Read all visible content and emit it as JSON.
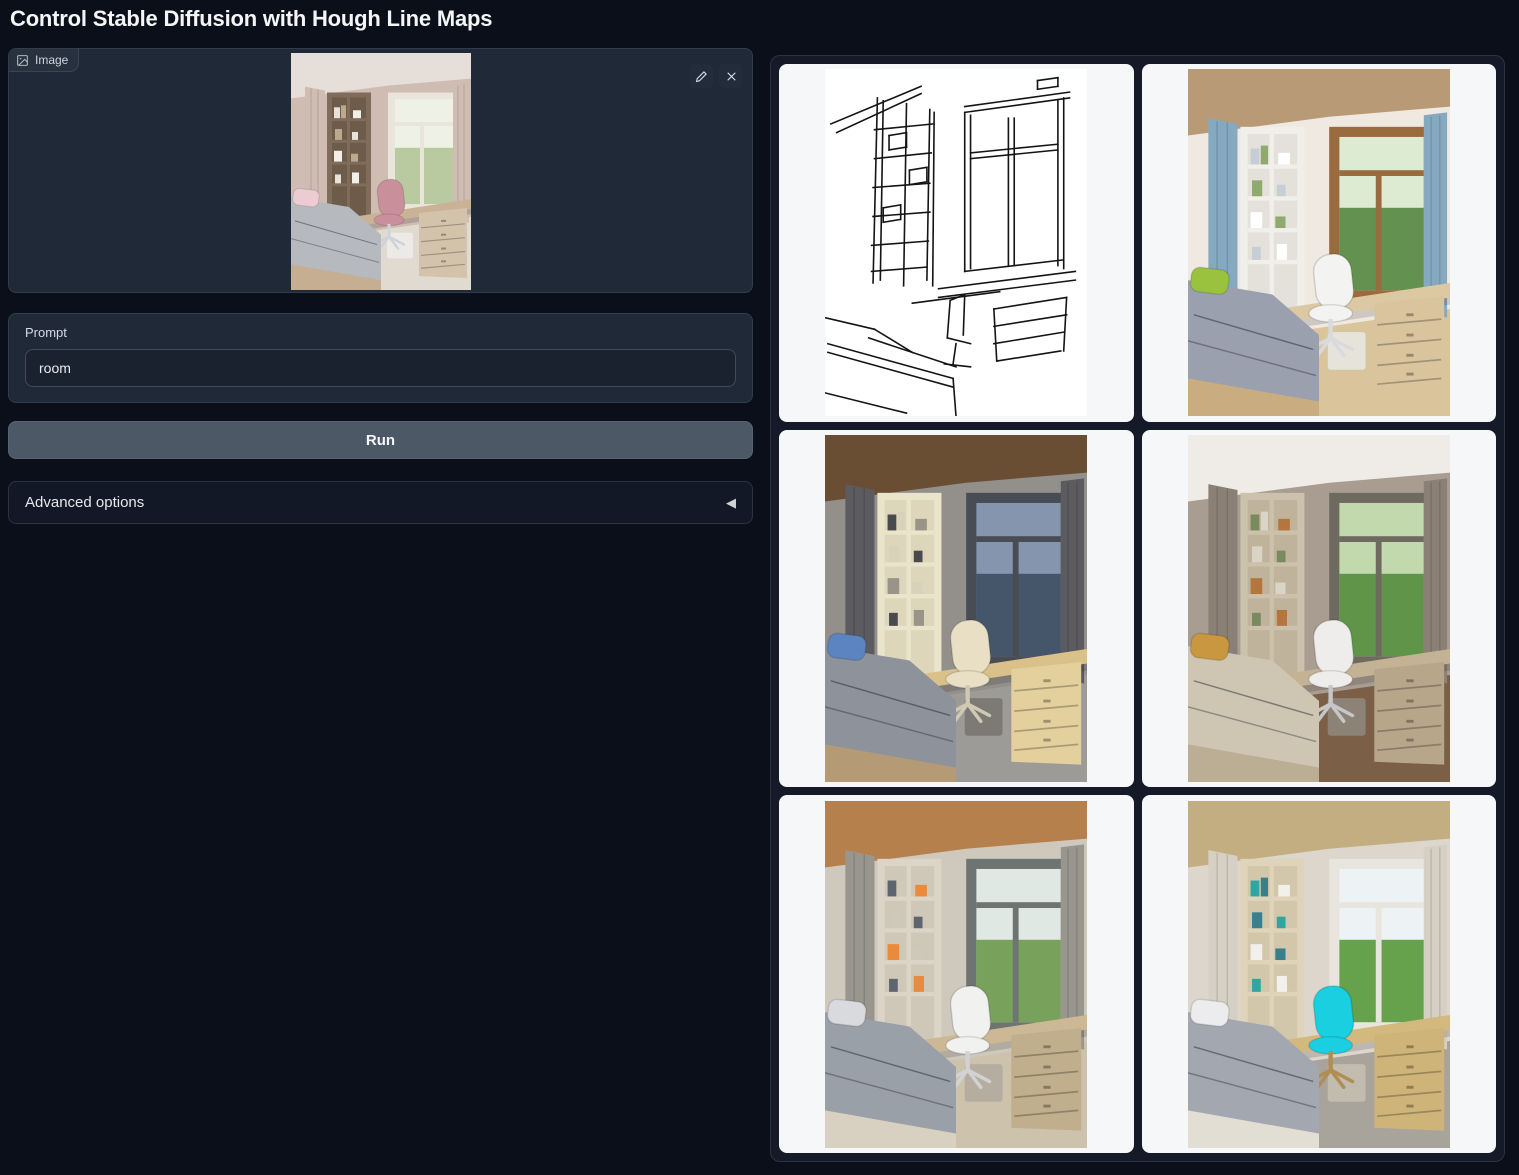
{
  "header": {
    "title": "Control Stable Diffusion with Hough Line Maps"
  },
  "input_panel": {
    "image_component": {
      "label": "Image",
      "edit_tooltip": "Edit",
      "clear_tooltip": "Clear",
      "image_description": "Uploaded photo of a child's bedroom with grey bed, pink desk chair, tall wooden bookshelf and bright window",
      "palette": {
        "wall": "#cfbcb2",
        "ceiling": "#e6ded8",
        "floor": "#e0dad0",
        "sky": "#eef2e6",
        "green": "#b9c9a0",
        "frame": "#e9e5db",
        "curtain": "#cfbcb2",
        "shelf": "#7f6c5a",
        "shelfin": "#6e5c4b",
        "desk": "#c9b296",
        "drawer": "#d3c3ab",
        "chair": "#c98f9b",
        "chairleg": "#cfd2d6",
        "bed": "#b6b9be",
        "bedframe": "#c6ae92",
        "pillow": "#ecccd2",
        "under": "#eceae6",
        "book1": "#e8e3d8",
        "book2": "#b9a98f",
        "book3": "#f2efe8"
      }
    },
    "prompt": {
      "label": "Prompt",
      "value": "room"
    },
    "run_button_label": "Run",
    "advanced_options_label": "Advanced options",
    "advanced_collapse_icon": "◀"
  },
  "gallery": {
    "items": [
      {
        "kind": "line_map",
        "description": "Hough line map (MLSD) extracted from the input room photo"
      },
      {
        "kind": "render",
        "description": "Generated bedroom with blue striped curtains, white shelving, wooden window frame and green pillow",
        "palette": {
          "wall": "#efe9e1",
          "ceiling": "#b99a76",
          "floor": "#d9c49c",
          "sky": "#dcebd2",
          "green": "#63914f",
          "frame": "#9a6b3f",
          "curtain": "#84a9c0",
          "shelf": "#f1efe9",
          "shelfin": "#e3e1da",
          "desk": "#dcc8a2",
          "drawer": "#d9c49e",
          "chair": "#f3f3f1",
          "chairleg": "#d9dade",
          "bed": "#9aa0ad",
          "bedframe": "#c9ac80",
          "pillow": "#9ac23e",
          "under": "#e6e3da",
          "book1": "#c7cdd4",
          "book2": "#8fa96e",
          "book3": "#ffffff"
        }
      },
      {
        "kind": "render",
        "description": "Generated bedroom at dusk with dark wood ceiling, grey curtains, cream shelving and blue pillow",
        "palette": {
          "wall": "#93908c",
          "ceiling": "#6a4e33",
          "floor": "#9c9b97",
          "sky": "#8495ad",
          "green": "#46566a",
          "frame": "#474c55",
          "curtain": "#5c5c60",
          "shelf": "#eae4cb",
          "shelfin": "#ddd6bb",
          "desk": "#d9c189",
          "drawer": "#e3d09c",
          "chair": "#e8dfc4",
          "chairleg": "#cfc9b4",
          "bed": "#8d929b",
          "bedframe": "#b59b75",
          "pillow": "#5b84c1",
          "under": "#7d7a75",
          "book1": "#4a4a4e",
          "book2": "#d8d2bb",
          "book3": "#9a9488"
        }
      },
      {
        "kind": "render",
        "description": "Generated bedroom in warm taupe tones with leafy green window view, mustard pillow and dark wood floor",
        "palette": {
          "wall": "#a99d91",
          "ceiling": "#efece7",
          "floor": "#7c5f47",
          "sky": "#c2d9ae",
          "green": "#5f9449",
          "frame": "#6f6a60",
          "curtain": "#8a8076",
          "shelf": "#ccc1aa",
          "shelfin": "#bfb39b",
          "desk": "#c4b294",
          "drawer": "#b8a68b",
          "chair": "#eeedeb",
          "chairleg": "#c6c6c8",
          "bed": "#cfc5b3",
          "bedframe": "#bcae94",
          "pillow": "#c9973f",
          "under": "#8d8276",
          "book1": "#7a8a5f",
          "book2": "#d9d4c6",
          "book3": "#b4763e"
        }
      },
      {
        "kind": "render",
        "description": "Generated bedroom with warm oak ceiling, grey curtains, white chair and grey patterned bedding",
        "palette": {
          "wall": "#cfc8bd",
          "ceiling": "#b5804b",
          "floor": "#cdc2ac",
          "sky": "#dfe8e2",
          "green": "#78a25b",
          "frame": "#6e7472",
          "curtain": "#99968e",
          "shelf": "#dcd5c7",
          "shelfin": "#cfc8b8",
          "desk": "#ccb895",
          "drawer": "#c1ae8d",
          "chair": "#f1f1ef",
          "chairleg": "#d2d2d4",
          "bed": "#9aa0a8",
          "bedframe": "#d8d1c1",
          "pillow": "#d8dadd",
          "under": "#b5ada0",
          "book1": "#5d6670",
          "book2": "#cfc9ba",
          "book3": "#e98b3a"
        }
      },
      {
        "kind": "render",
        "description": "Generated bedroom in light tones with bright cyan desk chair and teal books",
        "accent": "#19cfe0",
        "palette": {
          "wall": "#dcd6cc",
          "ceiling": "#c3ae81",
          "floor": "#a8a39b",
          "sky": "#edf2f4",
          "green": "#66a24c",
          "frame": "#e7e5de",
          "curtain": "#d6d0c4",
          "shelf": "#dfd4ba",
          "shelfin": "#d2c7ab",
          "desk": "#d3b97d",
          "drawer": "#ceb479",
          "chair": "#19cfe0",
          "chairleg": "#b08d52",
          "bed": "#a3a7b0",
          "bedframe": "#e3ded3",
          "pillow": "#ececee",
          "under": "#c2bcae",
          "book1": "#2fa6a0",
          "book2": "#3a7f8c",
          "book3": "#f2f0ea"
        }
      }
    ]
  },
  "theme": {
    "page_bg": "#0b0f19",
    "panel_bg": "#1f2937",
    "input_bg": "#1a2230",
    "run_button_bg": "#4d5867",
    "gallery_bg": "#141a28",
    "cell_bg": "#f5f7f9",
    "accent_chair": "#19cfe0"
  }
}
